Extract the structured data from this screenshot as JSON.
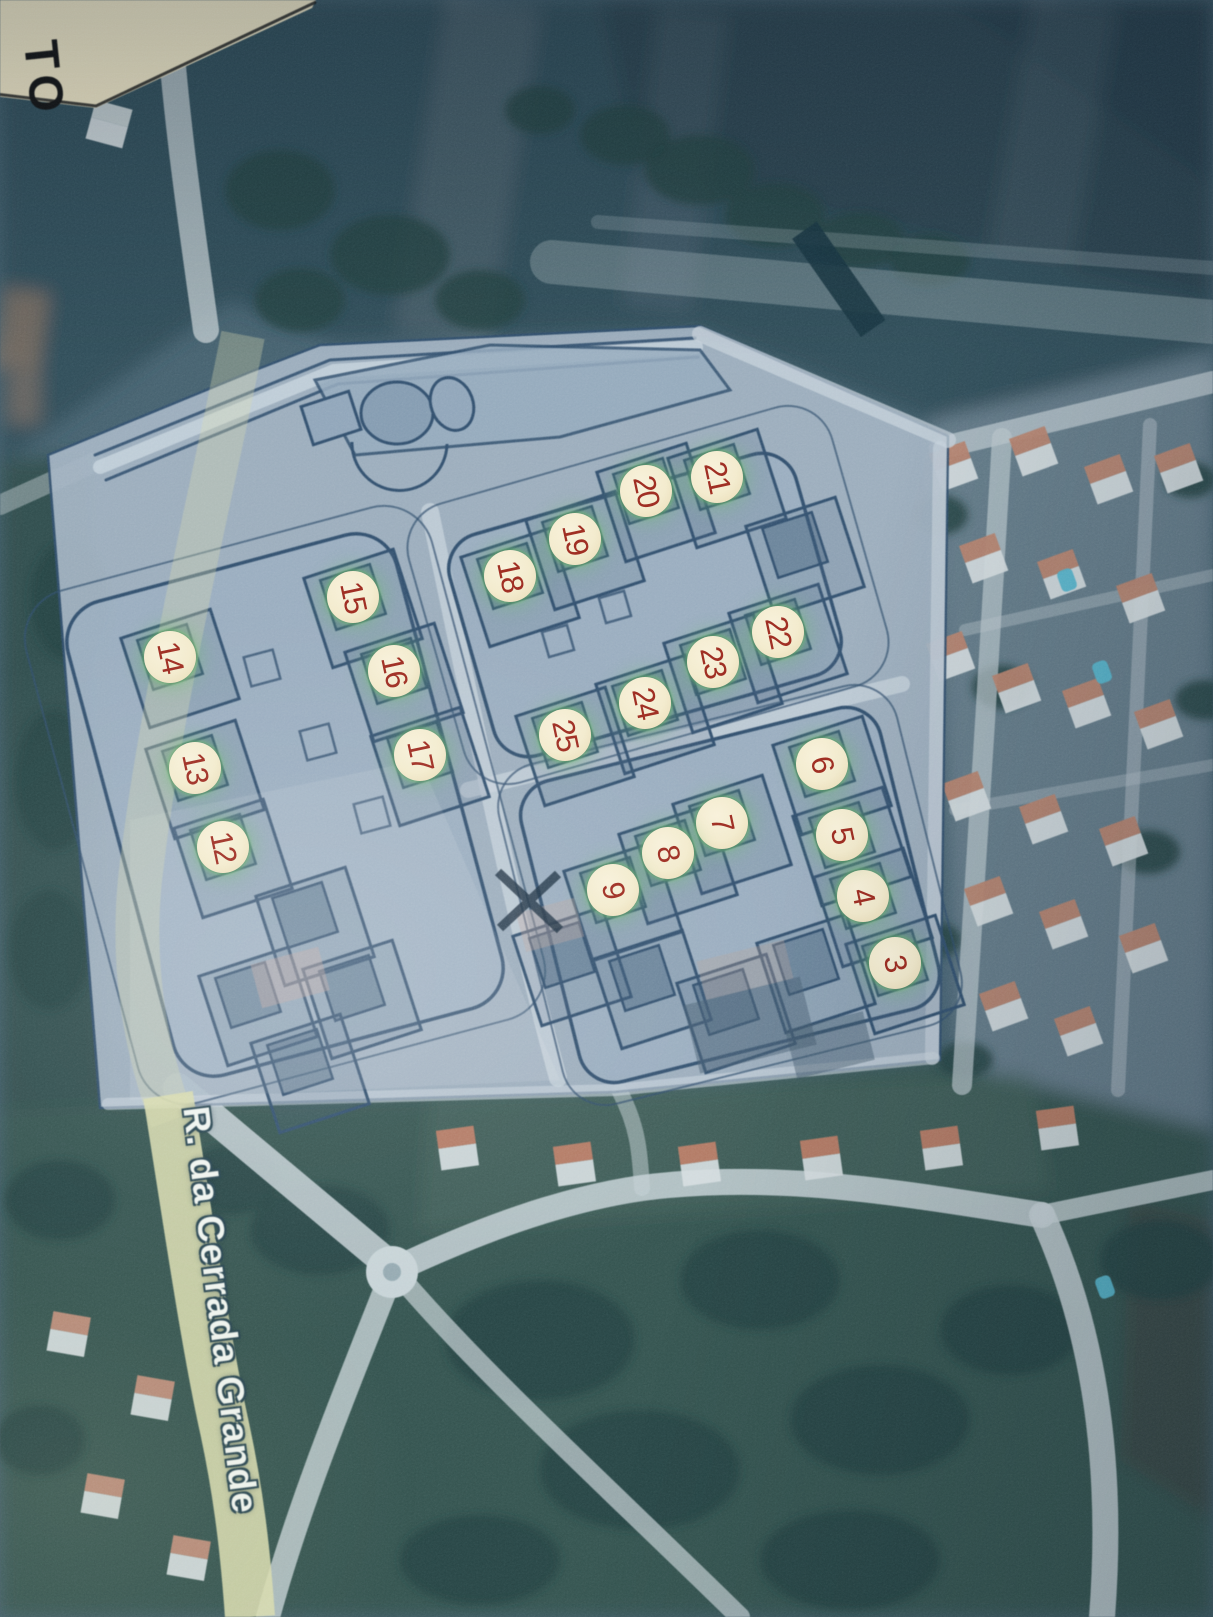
{
  "map": {
    "street_label": "R. da Cerrada Grande",
    "corner_label": "TO",
    "colors": {
      "marker_fill": "#f3ebcd",
      "marker_number": "#9d2b20",
      "marker_glow": "#6ebe6e",
      "street_text": "#eff4ef",
      "street_outline": "#26434f",
      "highlight_road": "#d6daab",
      "plan_fill": "#9fb0c0",
      "plan_line": "#2b4968",
      "paper_corner": "#efe6c4"
    },
    "markers": [
      {
        "label": "3",
        "x": 895,
        "y": 963
      },
      {
        "label": "4",
        "x": 863,
        "y": 896
      },
      {
        "label": "5",
        "x": 842,
        "y": 835
      },
      {
        "label": "6",
        "x": 822,
        "y": 764
      },
      {
        "label": "7",
        "x": 722,
        "y": 823
      },
      {
        "label": "8",
        "x": 668,
        "y": 853
      },
      {
        "label": "9",
        "x": 613,
        "y": 890
      },
      {
        "label": "12",
        "x": 223,
        "y": 847
      },
      {
        "label": "13",
        "x": 195,
        "y": 768
      },
      {
        "label": "14",
        "x": 170,
        "y": 657
      },
      {
        "label": "15",
        "x": 353,
        "y": 597
      },
      {
        "label": "16",
        "x": 394,
        "y": 671
      },
      {
        "label": "17",
        "x": 420,
        "y": 755
      },
      {
        "label": "18",
        "x": 510,
        "y": 576
      },
      {
        "label": "19",
        "x": 575,
        "y": 539
      },
      {
        "label": "20",
        "x": 646,
        "y": 491
      },
      {
        "label": "21",
        "x": 717,
        "y": 477
      },
      {
        "label": "22",
        "x": 778,
        "y": 632
      },
      {
        "label": "23",
        "x": 713,
        "y": 662
      },
      {
        "label": "24",
        "x": 645,
        "y": 703
      },
      {
        "label": "25",
        "x": 565,
        "y": 735
      }
    ]
  }
}
